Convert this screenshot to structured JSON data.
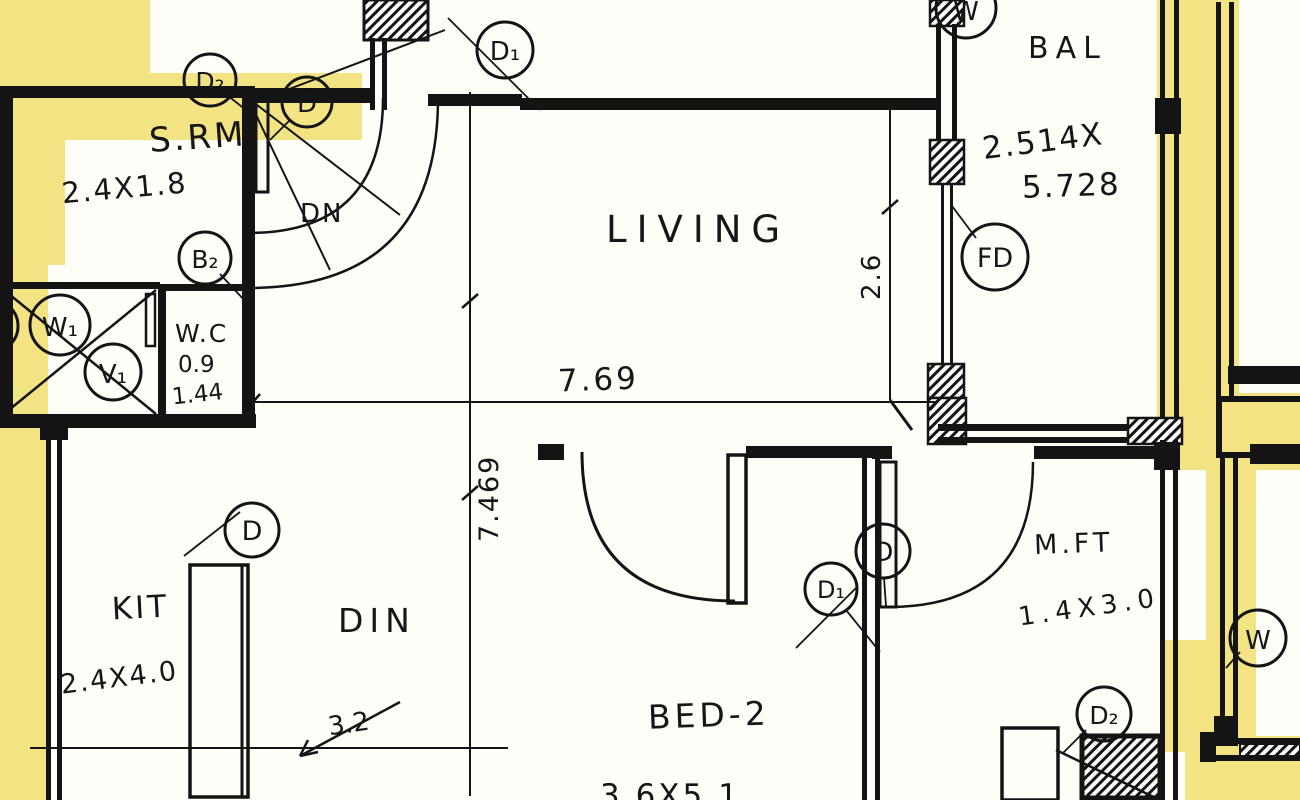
{
  "colors": {
    "highlighter": "#f1df6e",
    "ink": "#141414",
    "paper": "#fffdf8"
  },
  "rooms": {
    "srm": {
      "name": "S.RM",
      "dims": "2.4X1.8"
    },
    "wc": {
      "name": "W.C",
      "width": "0.9",
      "depth": "1.44"
    },
    "living": {
      "name": "LIVING"
    },
    "balcony": {
      "name": "BAL",
      "dims_line1": "2.514X",
      "dims_line2": "5.728"
    },
    "kitchen": {
      "name": "KIT",
      "dims": "2.4X4.0"
    },
    "dining": {
      "name": "DIN"
    },
    "bed2": {
      "name": "BED-2",
      "dims": "3.6X5.1"
    },
    "mft": {
      "name": "M.FT",
      "dims": "1.4X3.0"
    }
  },
  "dims": {
    "living_width": "7.69",
    "plan_depth": "7.469",
    "balcony_opening": "2.6",
    "dining_width": "3.2"
  },
  "stair": {
    "label": "DN"
  },
  "markers": {
    "d2_top": "D₂",
    "d_top": "D",
    "d1_top": "D₁",
    "w_top": "W",
    "fd": "FD",
    "b2": "B₂",
    "w1": "W₁",
    "v1": "V₁",
    "d_kit": "D",
    "d_bed": "D",
    "d1_bed": "D₁",
    "d2_bottom": "D₂",
    "w_right": "W"
  }
}
